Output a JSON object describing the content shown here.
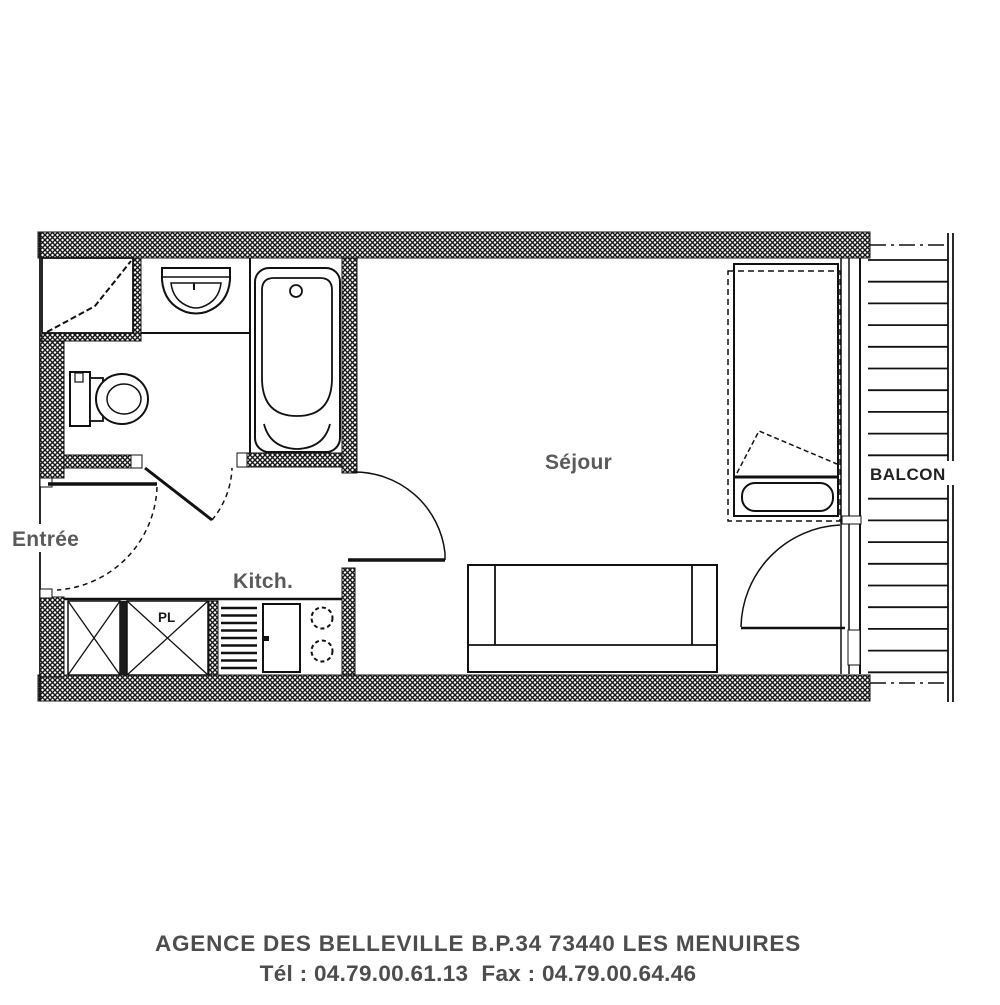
{
  "title": "studio-apartment-floor-plan",
  "labels": {
    "entree": "Entrée",
    "kitchen": "Kitch.",
    "living": "Séjour",
    "balcony": "BALCON",
    "closet": "PL"
  },
  "footer": {
    "line1": "AGENCE DES BELLEVILLE B.P.34 73440 LES MENUIRES",
    "line2": "Tél : 04.79.00.61.13  Fax : 04.79.00.64.46"
  },
  "colors": {
    "wall_line": "#111111",
    "room_label": "#5a5a5a",
    "footer_text": "#4d4d4d",
    "background": "#ffffff"
  }
}
